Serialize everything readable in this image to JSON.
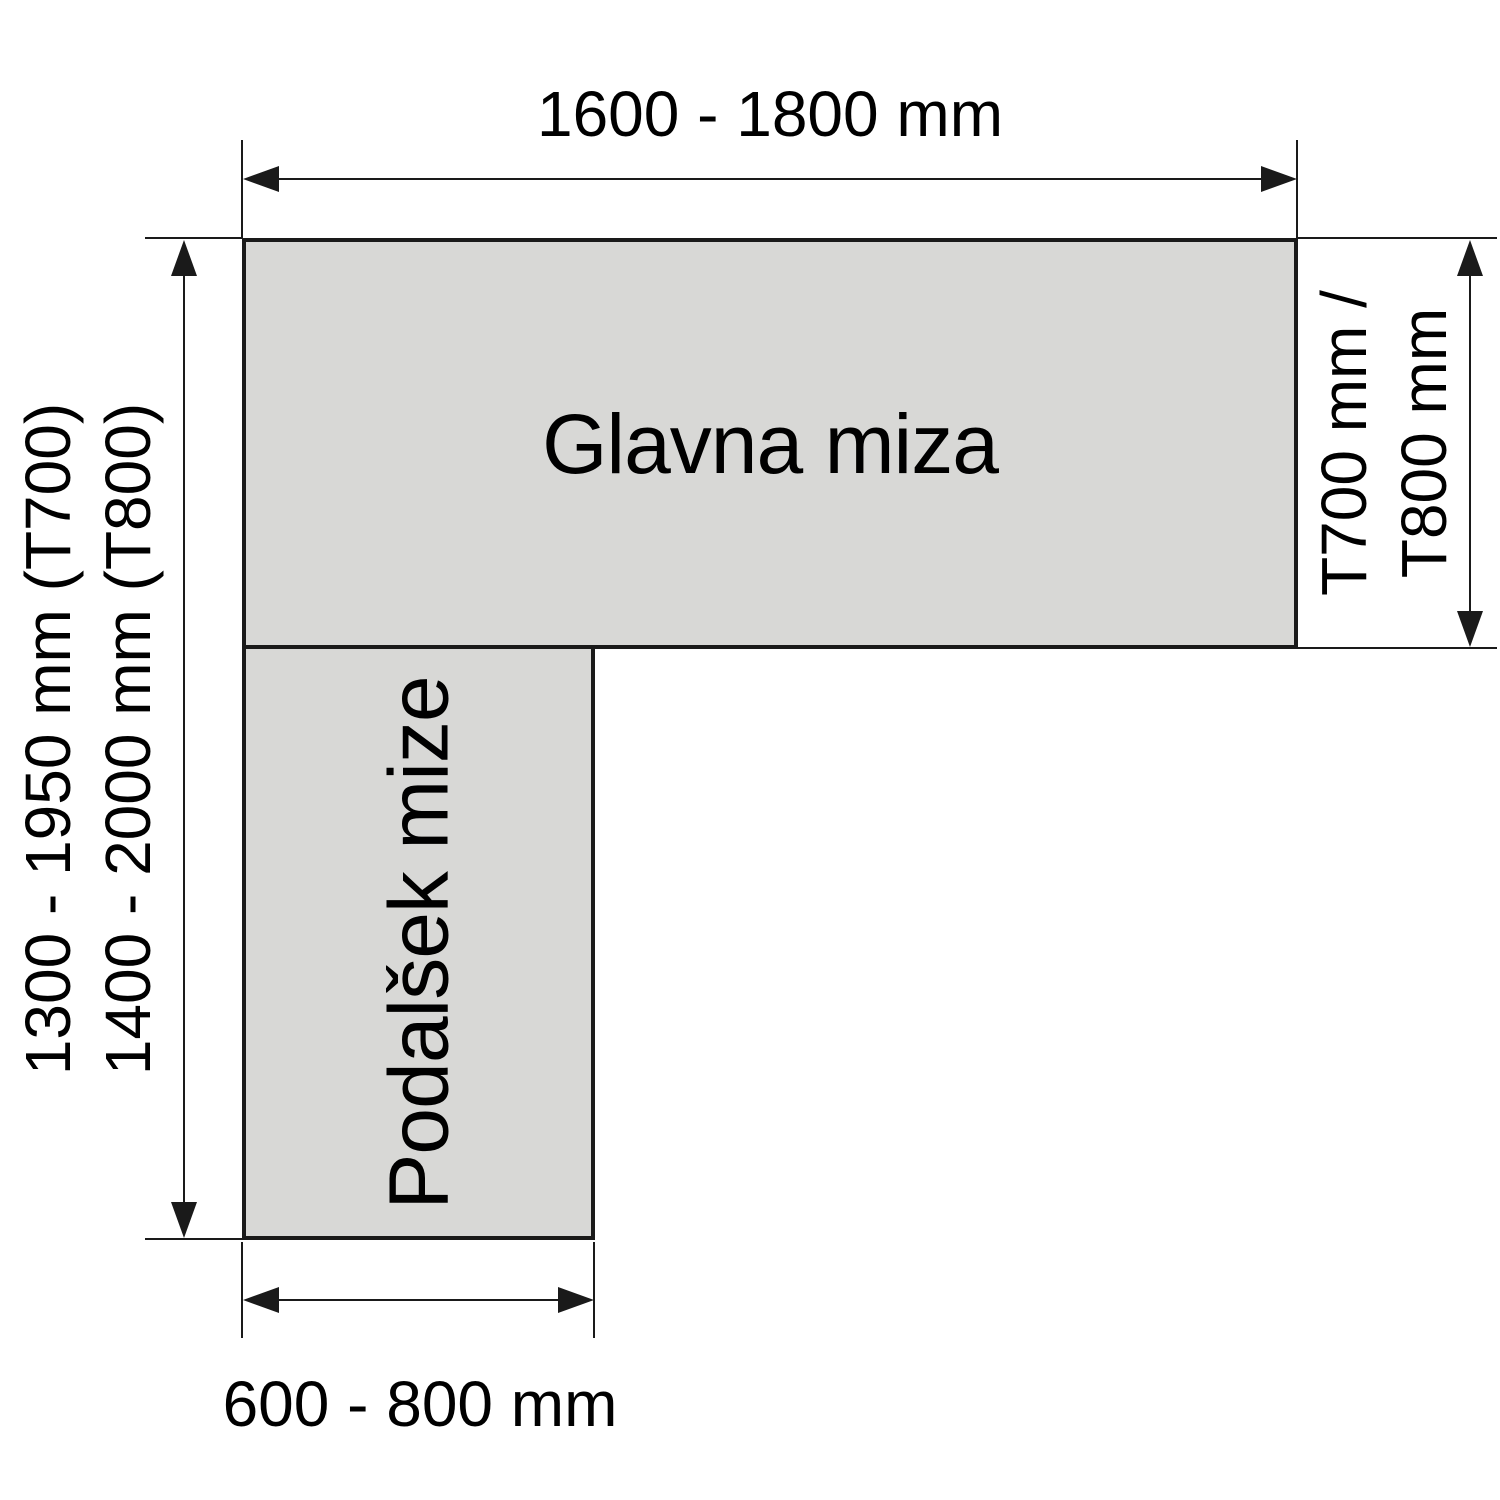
{
  "tables": {
    "main": {
      "label": "Glavna miza"
    },
    "extension": {
      "label": "Podalšek mize"
    }
  },
  "dimensions": {
    "top_width": {
      "label": "1600 - 1800 mm"
    },
    "left_height": {
      "lines": [
        "1300 - 1950 mm (T700)",
        "1400 - 2000 mm (T800)"
      ]
    },
    "right_depth": {
      "lines": [
        "T700 mm /",
        "T800 mm"
      ]
    },
    "bottom_width": {
      "label": "600 - 800 mm"
    }
  },
  "colors": {
    "table_fill": "#d8d8d6",
    "line": "#1a1a1a",
    "text": "#000000",
    "background": "#ffffff"
  }
}
